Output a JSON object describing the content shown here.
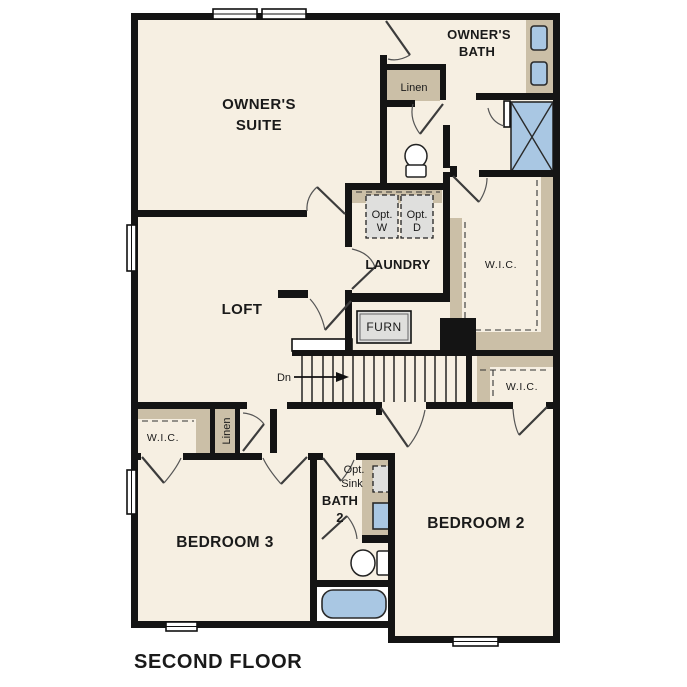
{
  "title": {
    "second_floor": "SECOND FLOOR"
  },
  "rooms": {
    "owners_suite_1": "OWNER'S",
    "owners_suite_2": "SUITE",
    "owners_bath_1": "OWNER'S",
    "owners_bath_2": "BATH",
    "loft": "LOFT",
    "laundry": "LAUNDRY",
    "bedroom2": "BEDROOM 2",
    "bedroom3": "BEDROOM 3",
    "bath2_1": "BATH",
    "bath2_2": "2",
    "wic_owners": "W.I.C.",
    "wic_bedroom2": "W.I.C.",
    "wic_bedroom3": "W.I.C.",
    "linen_top": "Linen",
    "linen_side": "Linen"
  },
  "fixtures": {
    "opt_w_1": "Opt.",
    "opt_w_2": "W",
    "opt_d_1": "Opt.",
    "opt_d_2": "D",
    "opt_sink_1": "Opt.",
    "opt_sink_2": "Sink",
    "furn": "FURN",
    "dn": "Dn"
  },
  "colors": {
    "paper": "#ffffff",
    "floor": "#f6efe2",
    "millwork": "#cbbfa7",
    "fixture": "#a9c7e3",
    "appliance": "#dfdfdd",
    "wall": "#141414",
    "ink": "#1a1a1a"
  }
}
